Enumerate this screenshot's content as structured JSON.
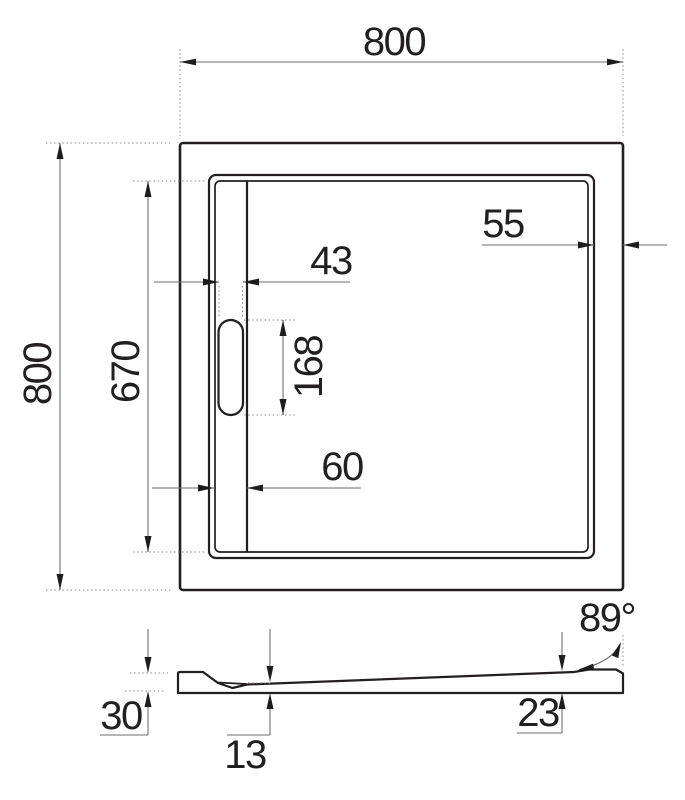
{
  "drawing": {
    "background_color": "#ffffff",
    "ink_color": "#231f20",
    "dim_line_color": "#6e6e6e",
    "plan_view": {
      "outer_width": "800",
      "outer_height": "800",
      "rim_width_right": "55",
      "drain_slot_width": "43",
      "drain_channel_length": "670",
      "drain_slot_length": "168",
      "drain_channel_width": "60"
    },
    "section_view": {
      "overall_height": "30",
      "base_thickness": "13",
      "edge_height": "23",
      "side_wall_angle": "89°"
    }
  }
}
